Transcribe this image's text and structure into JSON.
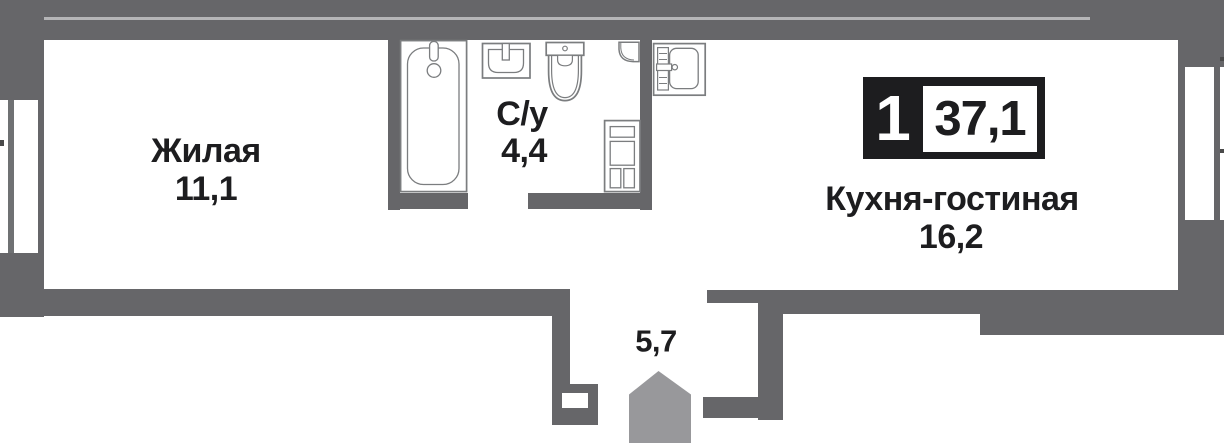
{
  "type": "apartment-floor-plan",
  "badge": {
    "rooms_count": "1",
    "total_area": "37,1"
  },
  "rooms": {
    "living": {
      "name": "Жилая",
      "area": "11,1"
    },
    "bathroom": {
      "name": "С/у",
      "area": "4,4"
    },
    "kitchen": {
      "name": "Кухня-гостиная",
      "area": "16,2"
    },
    "hallway": {
      "area": "5,7"
    }
  },
  "fixtures": [
    "bathtub",
    "washbasin",
    "toilet",
    "door-swing",
    "storage-cabinet",
    "kitchen-sink"
  ],
  "markers": {
    "entrance": "pentagon-house"
  },
  "colors": {
    "background": "#ffffff",
    "wall": "#666669",
    "wall_divider_line": "#b5b5b7",
    "window_frame": "#6f7173",
    "fixture_stroke": "#7b7d7f",
    "entrance_marker": "#98989b",
    "text": "#1d1d1f",
    "badge_bg": "#1d1d1f",
    "badge_text_on_dark": "#ffffff"
  }
}
